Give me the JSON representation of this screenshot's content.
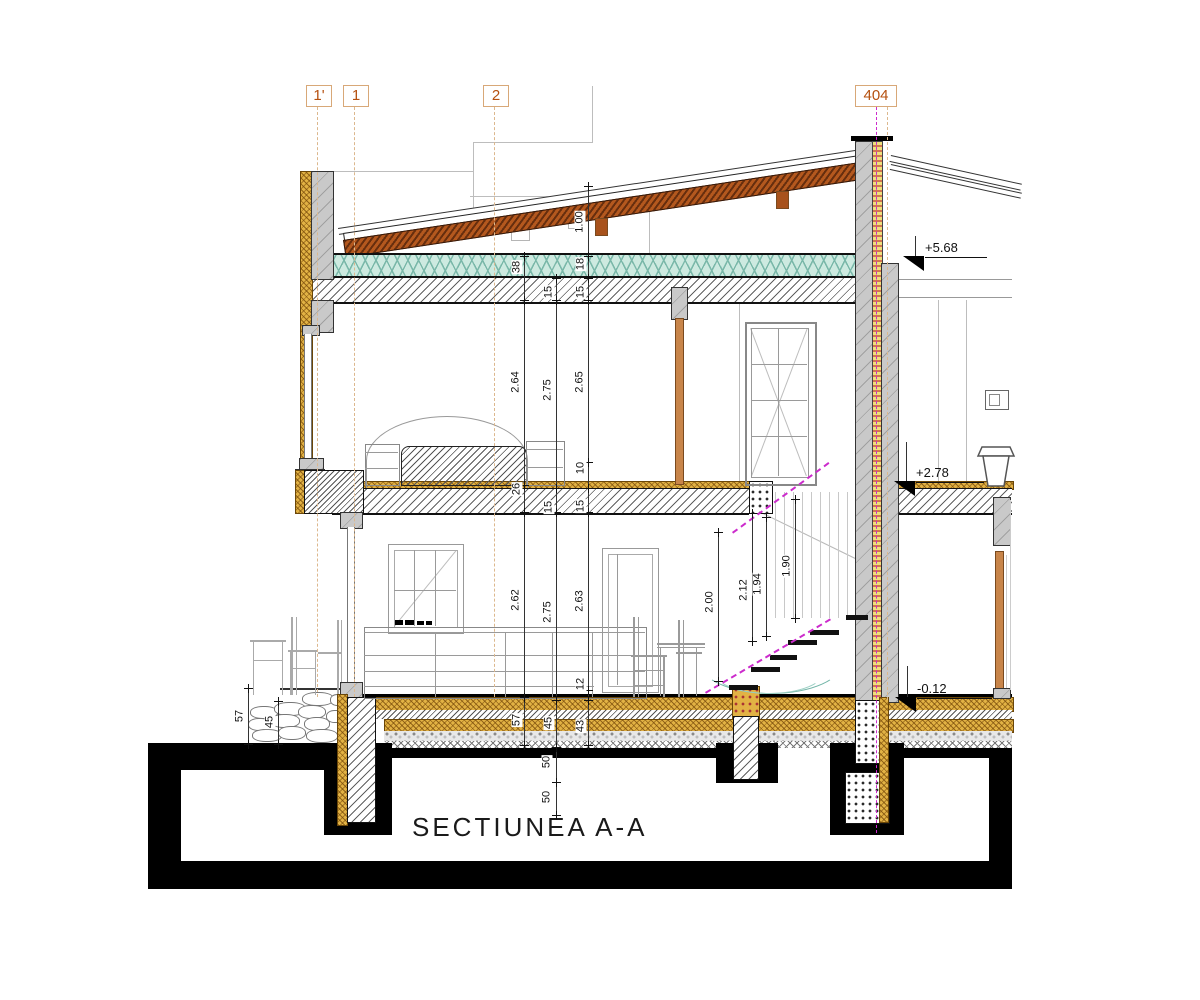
{
  "title": "SECTIUNEA A-A",
  "axes": {
    "x1p": "1'",
    "x1": "1",
    "x2": "2",
    "x404": "404"
  },
  "levels": {
    "roof": "+5.68",
    "floor1": "+2.78",
    "ground": "-0.12"
  },
  "dims": {
    "roof": "1.00",
    "chainA": [
      "38",
      "2.64",
      "26",
      "2.62",
      "57"
    ],
    "chainB": [
      "15",
      "2.75",
      "15",
      "2.75",
      "45",
      "50",
      "50"
    ],
    "chainC": [
      "18",
      "15",
      "2.65",
      "10",
      "15",
      "2.63",
      "12",
      "43"
    ],
    "stairs": [
      "2.00",
      "2.12",
      "1.94",
      "1.90"
    ],
    "terrace": [
      "57",
      "45"
    ]
  },
  "colors": {
    "roof_wood": "#b4581e",
    "insulation_gold": "#e2b244",
    "insulation_teal": "#cdeae0",
    "section_line_magenta": "#cc2bcc",
    "axis_label": "#b5500f"
  }
}
